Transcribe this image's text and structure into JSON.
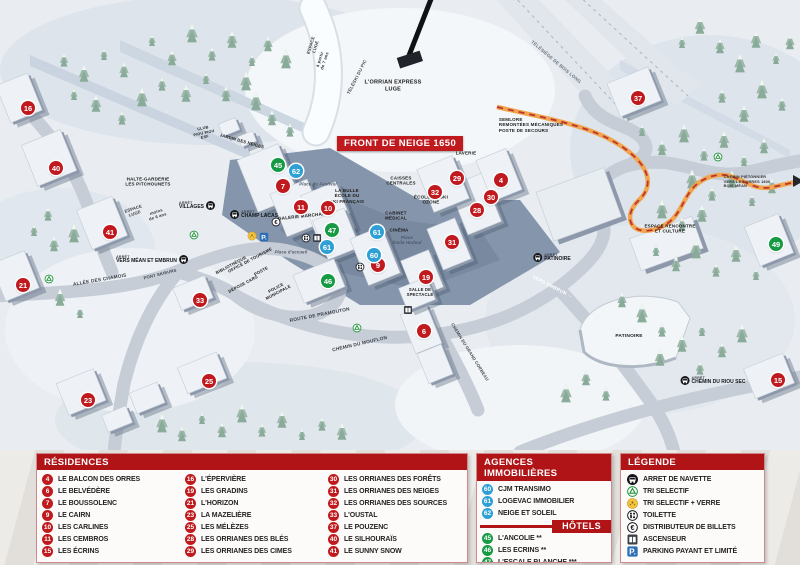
{
  "map": {
    "banner": "FRONT DE NEIGE 1650",
    "arret_label": "ARRÊT",
    "labels": [
      {
        "t": "L'ORRIAN EXPRESS\nLUGE",
        "x": 393,
        "y": 86,
        "s": 5.5
      },
      {
        "t": "TÉLÉSKI DU PIC",
        "x": 357,
        "y": 77,
        "r": -63,
        "s": 4.5,
        "c": "#4a515c"
      },
      {
        "t": "TÉLÉSIÈGE DE BOIS LONG",
        "x": 556,
        "y": 62,
        "r": 40,
        "s": 4.5,
        "c": "#6a7380"
      },
      {
        "t": "SEMLORE\nREMONTÉES MÉCANIQUES\nPOSTE DE SECOURS",
        "x": 531,
        "y": 125,
        "s": 4.5,
        "a": "left"
      },
      {
        "t": "LAVERIE",
        "x": 466,
        "y": 153,
        "s": 4.5
      },
      {
        "t": "CAISSES\nCENTRALES",
        "x": 401,
        "y": 181,
        "s": 4.5
      },
      {
        "t": "ÉCOLE DE SKI\nOZONE",
        "x": 431,
        "y": 200,
        "s": 4.5
      },
      {
        "t": "CABINET\nMÉDICAL",
        "x": 396,
        "y": 216,
        "s": 4.5
      },
      {
        "t": "CINÉMA",
        "x": 399,
        "y": 230,
        "s": 4.5
      },
      {
        "t": "Place\nÉmile Hodoul",
        "x": 407,
        "y": 240,
        "s": 4.2,
        "i": 1,
        "c": "#4d5666"
      },
      {
        "t": "LA BULLE\nÉCOLE DU\nSKI FRANÇAIS",
        "x": 347,
        "y": 196,
        "s": 4.5
      },
      {
        "t": "Place du Festival",
        "x": 318,
        "y": 184,
        "s": 4.2,
        "i": 1,
        "c": "#4d5666"
      },
      {
        "t": "GALERIE MARCHANDE",
        "x": 305,
        "y": 216,
        "r": -6,
        "s": 4.5
      },
      {
        "t": "HALTE-GARDERIE\nLES PITCHOUNETS",
        "x": 148,
        "y": 182,
        "s": 4.5
      },
      {
        "t": "ESPACE\nLUGE",
        "x": 134,
        "y": 211,
        "r": -18,
        "s": 4.2,
        "c": "#333333"
      },
      {
        "t": "moins\nde 6 ans",
        "x": 157,
        "y": 214,
        "r": -18,
        "s": 4.2,
        "c": "#333333"
      },
      {
        "t": "ESPACE\nLUGE",
        "x": 313,
        "y": 46,
        "r": -72,
        "s": 4.2,
        "c": "#333333"
      },
      {
        "t": "à partir\nde 7 ans",
        "x": 322,
        "y": 60,
        "r": -72,
        "s": 4.2,
        "c": "#333333"
      },
      {
        "t": "CLUB\nPIOU PIOU\nESF",
        "x": 204,
        "y": 133,
        "r": -12,
        "s": 3.8
      },
      {
        "t": "JARDIN DES NEIGES",
        "x": 242,
        "y": 141,
        "r": 16,
        "s": 4.2
      },
      {
        "t": "PONT SKIEURS",
        "x": 160,
        "y": 274,
        "r": -14,
        "s": 4.2,
        "c": "#3a3f47"
      },
      {
        "t": "ALLÉE DES CHAMOIS",
        "x": 100,
        "y": 281,
        "r": -10,
        "s": 4.8,
        "c": "#3a3f47"
      },
      {
        "t": "OFFICE DE TOURISME",
        "x": 250,
        "y": 260,
        "r": -28,
        "s": 4.2
      },
      {
        "t": "BIBLIOTHÈQUE",
        "x": 231,
        "y": 265,
        "r": -28,
        "s": 4.2
      },
      {
        "t": "POSTE",
        "x": 261,
        "y": 271,
        "r": -28,
        "s": 4.2
      },
      {
        "t": "DÉPOSE CARS",
        "x": 243,
        "y": 284,
        "r": -28,
        "s": 4.2
      },
      {
        "t": "POLICE\nMUNICIPALE",
        "x": 277,
        "y": 290,
        "r": -28,
        "s": 4.2
      },
      {
        "t": "Place d'accueil",
        "x": 291,
        "y": 252,
        "s": 4.2,
        "i": 1,
        "c": "#4d5666"
      },
      {
        "t": "ROUTE DE PRAMOUTON",
        "x": 320,
        "y": 316,
        "r": -11,
        "s": 4.8,
        "c": "#3a3f47"
      },
      {
        "t": "CHEMIN DU MOUFLON",
        "x": 360,
        "y": 345,
        "r": -13,
        "s": 4.8,
        "c": "#3a3f47"
      },
      {
        "t": "CHEMIN DU GRAND CORBEAU",
        "x": 470,
        "y": 352,
        "r": 58,
        "s": 4.2,
        "c": "#3a3f47"
      },
      {
        "t": "SALLE DE\nSPECTACLE",
        "x": 420,
        "y": 292,
        "s": 4.2
      },
      {
        "t": "PATINOIRE",
        "x": 629,
        "y": 337,
        "s": 4.8
      },
      {
        "t": "ESPACE RENCONTRE\nET CULTURE",
        "x": 670,
        "y": 229,
        "s": 4.5
      },
      {
        "t": "VERS EMBRUN →",
        "x": 552,
        "y": 288,
        "r": 27,
        "s": 4.8,
        "c": "#ffffff"
      },
      {
        "t": "CHEMIN PIÉTONNIER\nVERS LES ORRES 1800\nBOIS MÉAN",
        "x": 747,
        "y": 182,
        "s": 3.8,
        "a": "left",
        "c": "#333333"
      }
    ],
    "bus_stops": [
      {
        "name": "VILLAGES",
        "x": 197,
        "y": 206,
        "side": "right"
      },
      {
        "name": "CHAMP LACAS",
        "x": 254,
        "y": 215,
        "side": "left"
      },
      {
        "name": "VERS MÉAN ET EMBRUN",
        "x": 152,
        "y": 260,
        "side": "right"
      },
      {
        "name": "PATINOIRE",
        "x": 552,
        "y": 258,
        "side": "left"
      },
      {
        "name": "CHEMIN DU RIOU SEC",
        "x": 713,
        "y": 381,
        "side": "left"
      }
    ],
    "markers": [
      {
        "n": "16",
        "c": "red",
        "x": 28,
        "y": 108
      },
      {
        "n": "40",
        "c": "red",
        "x": 56,
        "y": 168
      },
      {
        "n": "41",
        "c": "red",
        "x": 110,
        "y": 232
      },
      {
        "n": "21",
        "c": "red",
        "x": 23,
        "y": 285
      },
      {
        "n": "33",
        "c": "red",
        "x": 200,
        "y": 300
      },
      {
        "n": "23",
        "c": "red",
        "x": 88,
        "y": 400
      },
      {
        "n": "25",
        "c": "red",
        "x": 209,
        "y": 381
      },
      {
        "n": "7",
        "c": "red",
        "x": 283,
        "y": 186
      },
      {
        "n": "11",
        "c": "red",
        "x": 301,
        "y": 207
      },
      {
        "n": "10",
        "c": "red",
        "x": 328,
        "y": 208
      },
      {
        "n": "9",
        "c": "red",
        "x": 378,
        "y": 265
      },
      {
        "n": "19",
        "c": "red",
        "x": 426,
        "y": 277
      },
      {
        "n": "6",
        "c": "red",
        "x": 424,
        "y": 331
      },
      {
        "n": "31",
        "c": "red",
        "x": 452,
        "y": 242
      },
      {
        "n": "28",
        "c": "red",
        "x": 477,
        "y": 210
      },
      {
        "n": "30",
        "c": "red",
        "x": 491,
        "y": 197
      },
      {
        "n": "4",
        "c": "red",
        "x": 501,
        "y": 180
      },
      {
        "n": "32",
        "c": "red",
        "x": 435,
        "y": 192
      },
      {
        "n": "29",
        "c": "red",
        "x": 457,
        "y": 178
      },
      {
        "n": "37",
        "c": "red",
        "x": 638,
        "y": 98
      },
      {
        "n": "15",
        "c": "red",
        "x": 778,
        "y": 380
      },
      {
        "n": "45",
        "c": "green",
        "x": 278,
        "y": 165
      },
      {
        "n": "46",
        "c": "green",
        "x": 328,
        "y": 281
      },
      {
        "n": "47",
        "c": "green",
        "x": 332,
        "y": 230
      },
      {
        "n": "49",
        "c": "green",
        "x": 776,
        "y": 244
      },
      {
        "n": "60",
        "c": "blue",
        "x": 374,
        "y": 255
      },
      {
        "n": "61",
        "c": "blue",
        "x": 327,
        "y": 247
      },
      {
        "n": "61",
        "c": "blue",
        "x": 377,
        "y": 232
      },
      {
        "n": "62",
        "c": "blue",
        "x": 296,
        "y": 171
      }
    ],
    "icons": [
      {
        "type": "recycle",
        "x": 194,
        "y": 235
      },
      {
        "type": "recycle",
        "x": 49,
        "y": 279
      },
      {
        "type": "recycle",
        "x": 357,
        "y": 328
      },
      {
        "type": "recycle",
        "x": 718,
        "y": 157
      },
      {
        "type": "glass",
        "x": 252,
        "y": 236
      },
      {
        "type": "parking",
        "x": 264,
        "y": 237
      },
      {
        "type": "atm",
        "x": 276,
        "y": 222
      },
      {
        "type": "toilet",
        "x": 306,
        "y": 238
      },
      {
        "type": "elevator",
        "x": 317,
        "y": 238
      },
      {
        "type": "toilet",
        "x": 360,
        "y": 267
      },
      {
        "type": "elevator",
        "x": 408,
        "y": 310
      }
    ]
  },
  "legend": {
    "residences": {
      "title": "RÉSIDENCES",
      "items": [
        {
          "n": "4",
          "label": "LE BALCON DES ORRES"
        },
        {
          "n": "6",
          "label": "LE BELVÉDÈRE"
        },
        {
          "n": "7",
          "label": "LE BOUSSOLENC"
        },
        {
          "n": "9",
          "label": "LE CAIRN"
        },
        {
          "n": "10",
          "label": "LES CARLINES"
        },
        {
          "n": "11",
          "label": "LES CEMBROS"
        },
        {
          "n": "15",
          "label": "LES ÉCRINS"
        },
        {
          "n": "16",
          "label": "L'ÉPERVIÈRE"
        },
        {
          "n": "19",
          "label": "LES GRADINS"
        },
        {
          "n": "21",
          "label": "L'HORIZON"
        },
        {
          "n": "23",
          "label": "LA MAZELIÈRE"
        },
        {
          "n": "25",
          "label": "LES MÉLÈZES"
        },
        {
          "n": "28",
          "label": "LES ORRIANES DES BLÉS"
        },
        {
          "n": "29",
          "label": "LES ORRIANES DES CIMES"
        },
        {
          "n": "30",
          "label": "LES ORRIANES DES FORÊTS"
        },
        {
          "n": "31",
          "label": "LES ORRIANES DES NEIGES"
        },
        {
          "n": "32",
          "label": "LES ORRIANES DES SOURCES"
        },
        {
          "n": "33",
          "label": "L'OUSTAL"
        },
        {
          "n": "37",
          "label": "LE POUZENC"
        },
        {
          "n": "40",
          "label": "LE SILHOURAÏS"
        },
        {
          "n": "41",
          "label": "LE SUNNY SNOW"
        }
      ]
    },
    "agences": {
      "title": "AGENCES IMMOBILIÈRES",
      "items": [
        {
          "n": "60",
          "label": "CJM TRANSIMO"
        },
        {
          "n": "61",
          "label": "LOGEVAC IMMOBILIER"
        },
        {
          "n": "62",
          "label": "NEIGE ET SOLEIL"
        }
      ]
    },
    "hotels": {
      "title": "HÔTELS",
      "items": [
        {
          "n": "45",
          "label": "L'ANCOLIE **"
        },
        {
          "n": "46",
          "label": "LES ECRINS **"
        },
        {
          "n": "47",
          "label": "L'ESCALE BLANCHE ***"
        },
        {
          "n": "49",
          "label": "LES TRAPPEURS **"
        }
      ]
    },
    "legende": {
      "title": "LÉGENDE",
      "items": [
        {
          "icon": "bus",
          "label": "ARRET DE NAVETTE"
        },
        {
          "icon": "recycle",
          "label": "TRI SELECTIF"
        },
        {
          "icon": "glass",
          "label": "TRI SELECTIF + VERRE"
        },
        {
          "icon": "toilet",
          "label": "TOILETTE"
        },
        {
          "icon": "atm",
          "label": "DISTRIBUTEUR DE BILLETS"
        },
        {
          "icon": "elevator",
          "label": "ASCENSEUR"
        },
        {
          "icon": "parking",
          "label": "PARKING PAYANT ET LIMITÉ"
        }
      ]
    }
  },
  "colors": {
    "red": "#c01a1f",
    "blue": "#2fa0d6",
    "green": "#169a44",
    "header_red": "#b01417"
  }
}
